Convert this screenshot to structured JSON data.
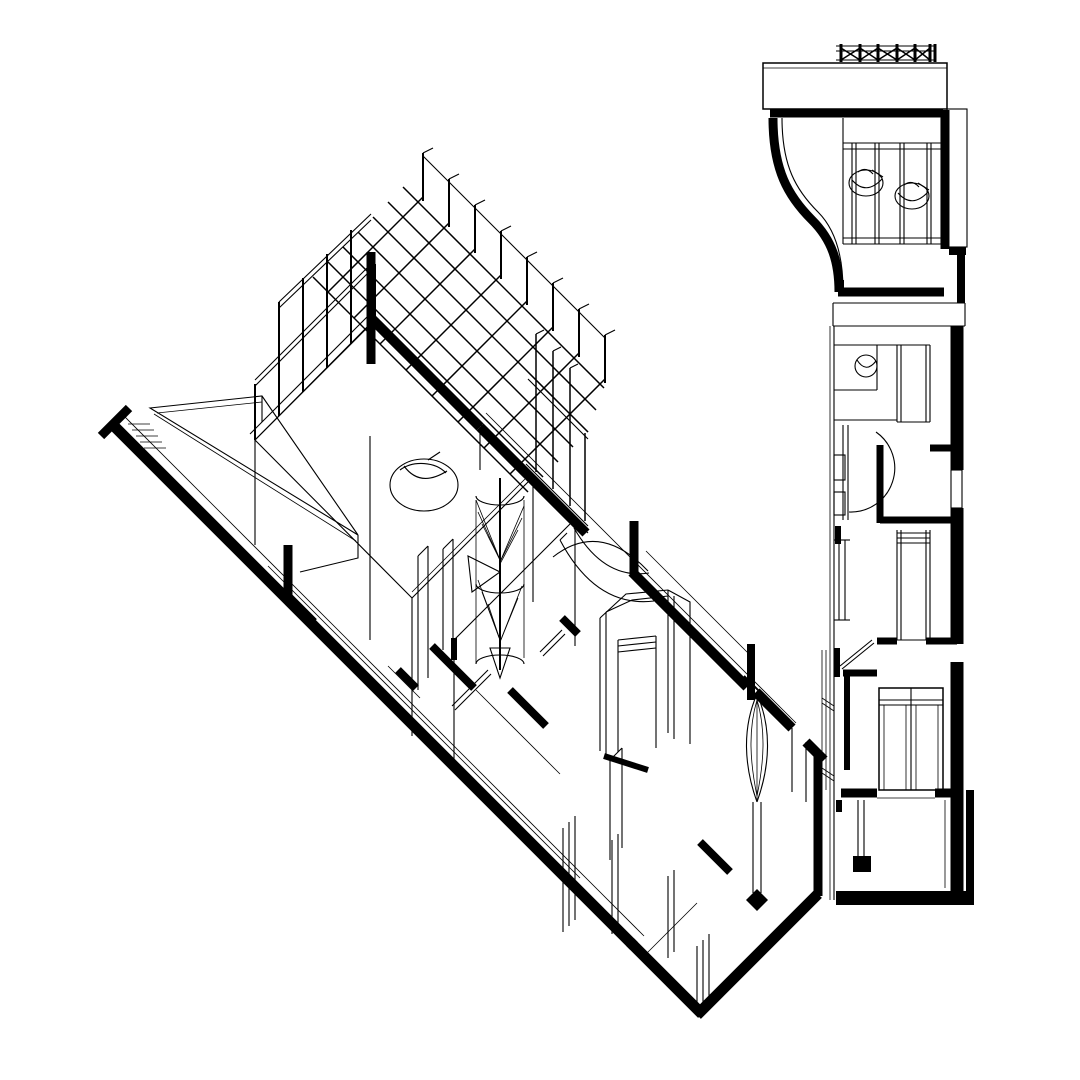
{
  "canvas": {
    "background": "#ffffff",
    "ink": "#000000"
  },
  "drawing": {
    "kind": "architectural-line-drawing",
    "views": {
      "axonometric": {
        "name": "axonometric-cutaway-wing",
        "elements": [
          "pergola-grid-roof",
          "roof-posts",
          "curtain-wall-mullions",
          "entry-ramp",
          "entry-steps",
          "cut-walls",
          "spiral-stair",
          "vault-arches",
          "octagonal-shaft",
          "palm-column",
          "door-frames",
          "open-door-leaves",
          "window-mullions",
          "armchair"
        ]
      },
      "plan_section_strip": {
        "name": "section-and-plan-strip",
        "elements": [
          "roof-truss",
          "roof-slab",
          "curved-section-wall",
          "window-wall-mullions",
          "armchairs",
          "landing-lines",
          "shaft",
          "bathroom",
          "door-swing-arc",
          "open-door-leaf",
          "glazed-double-door",
          "balcony-edge",
          "stub-wall",
          "terrace-room"
        ]
      }
    }
  }
}
